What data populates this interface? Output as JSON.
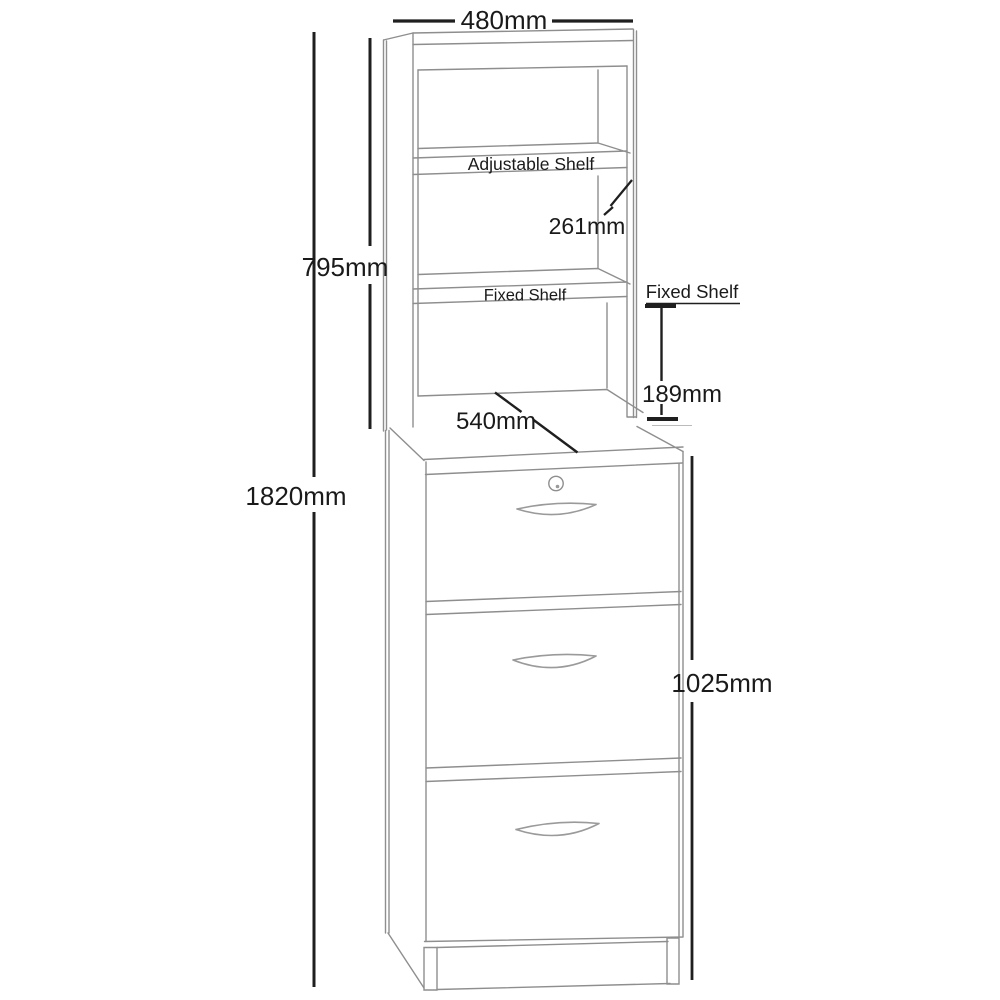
{
  "diagram": {
    "type": "furniture-dimension-drawing",
    "subject": "three-drawer filing cabinet with shelf hutch",
    "background_color": "#ffffff",
    "furniture_line_color": "#8e8e8e",
    "dimension_line_color": "#1f1f1f",
    "annotations": {
      "top_width": "480mm",
      "hutch_height": "795mm",
      "shelf_spacing": "261mm",
      "adjustable_shelf_label": "Adjustable Shelf",
      "fixed_shelf_label": "Fixed Shelf",
      "fixed_shelf_callout": "Fixed Shelf",
      "fixed_shelf_height": "189mm",
      "worktop_depth": "540mm",
      "total_height": "1820mm",
      "cabinet_height": "1025mm"
    }
  }
}
